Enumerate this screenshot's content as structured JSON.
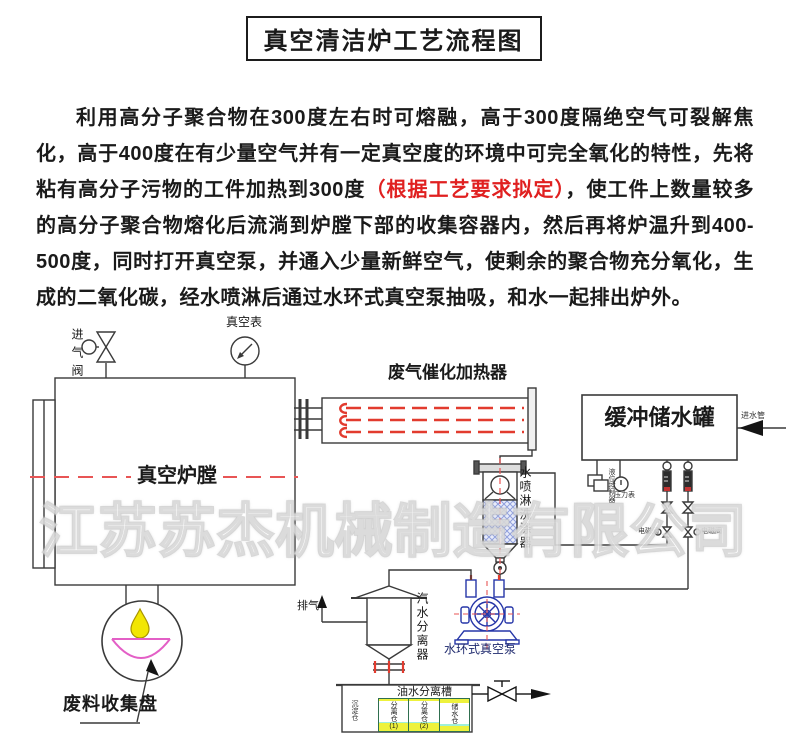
{
  "title": "真空清洁炉工艺流程图",
  "intro": {
    "text_before_red": "利用高分子聚合物在300度左右时可熔融，高于300度隔绝空气可裂解焦化，高于400度在有少量空气并有一定真空度的环境中可完全氧化的特性，先将粘有高分子污物的工件加热到300度",
    "red_note": "（根据工艺要求拟定）",
    "text_after_red": "，使工件上数量较多的高分子聚合物熔化后流淌到炉膛下部的收集容器内，然后再将炉温升到400-500度，同时打开真空泵，并通入少量新鲜空气，使剩余的聚合物充分氧化，生成的二氧化碳，经水喷淋后通过水环式真空泵抽吸，和水一起排出炉外。"
  },
  "diagram": {
    "labels": {
      "intake_valve": "进气阀",
      "vacuum_gauge": "真空表",
      "furnace_chamber": "真空炉膛",
      "catalytic_heater": "废气催化加热器",
      "buffer_tank": "缓冲储水罐",
      "water_inlet_pipe": "进水管",
      "level_controller": "液位控制器",
      "pressure_gauge": "压力表",
      "solenoid_valve_left": "电磁阀",
      "solenoid_valve_right": "电磁阀",
      "spray_scrubber": "水喷淋洗涤器",
      "steam_water_separator": "汽水分离器",
      "exhaust": "排气",
      "water_ring_vacuum_pump": "水环式真空泵",
      "oil_water_separation_tank": "油水分离槽",
      "waste_collection_tray": "废料收集盘",
      "settling_compartment": "沉淀仓",
      "compartments": [
        {
          "name": "分离仓",
          "num": "(1)"
        },
        {
          "name": "分离仓",
          "num": "(2)"
        },
        {
          "name": "储水仓",
          "num": ""
        }
      ]
    },
    "watermark": "江苏苏杰机械制造有限公司",
    "colors": {
      "line": "#3a3a3a",
      "centerline_red": "#e85555",
      "heater_red": "#e23b2e",
      "pump_blue": "#2636a8",
      "droplet_yellow": "#f2e603",
      "bowl_magenta": "#e35fc6",
      "cell_yellow": "#eef23c",
      "cell_cyan": "#9ff0d9",
      "note_red": "#e02020"
    }
  }
}
